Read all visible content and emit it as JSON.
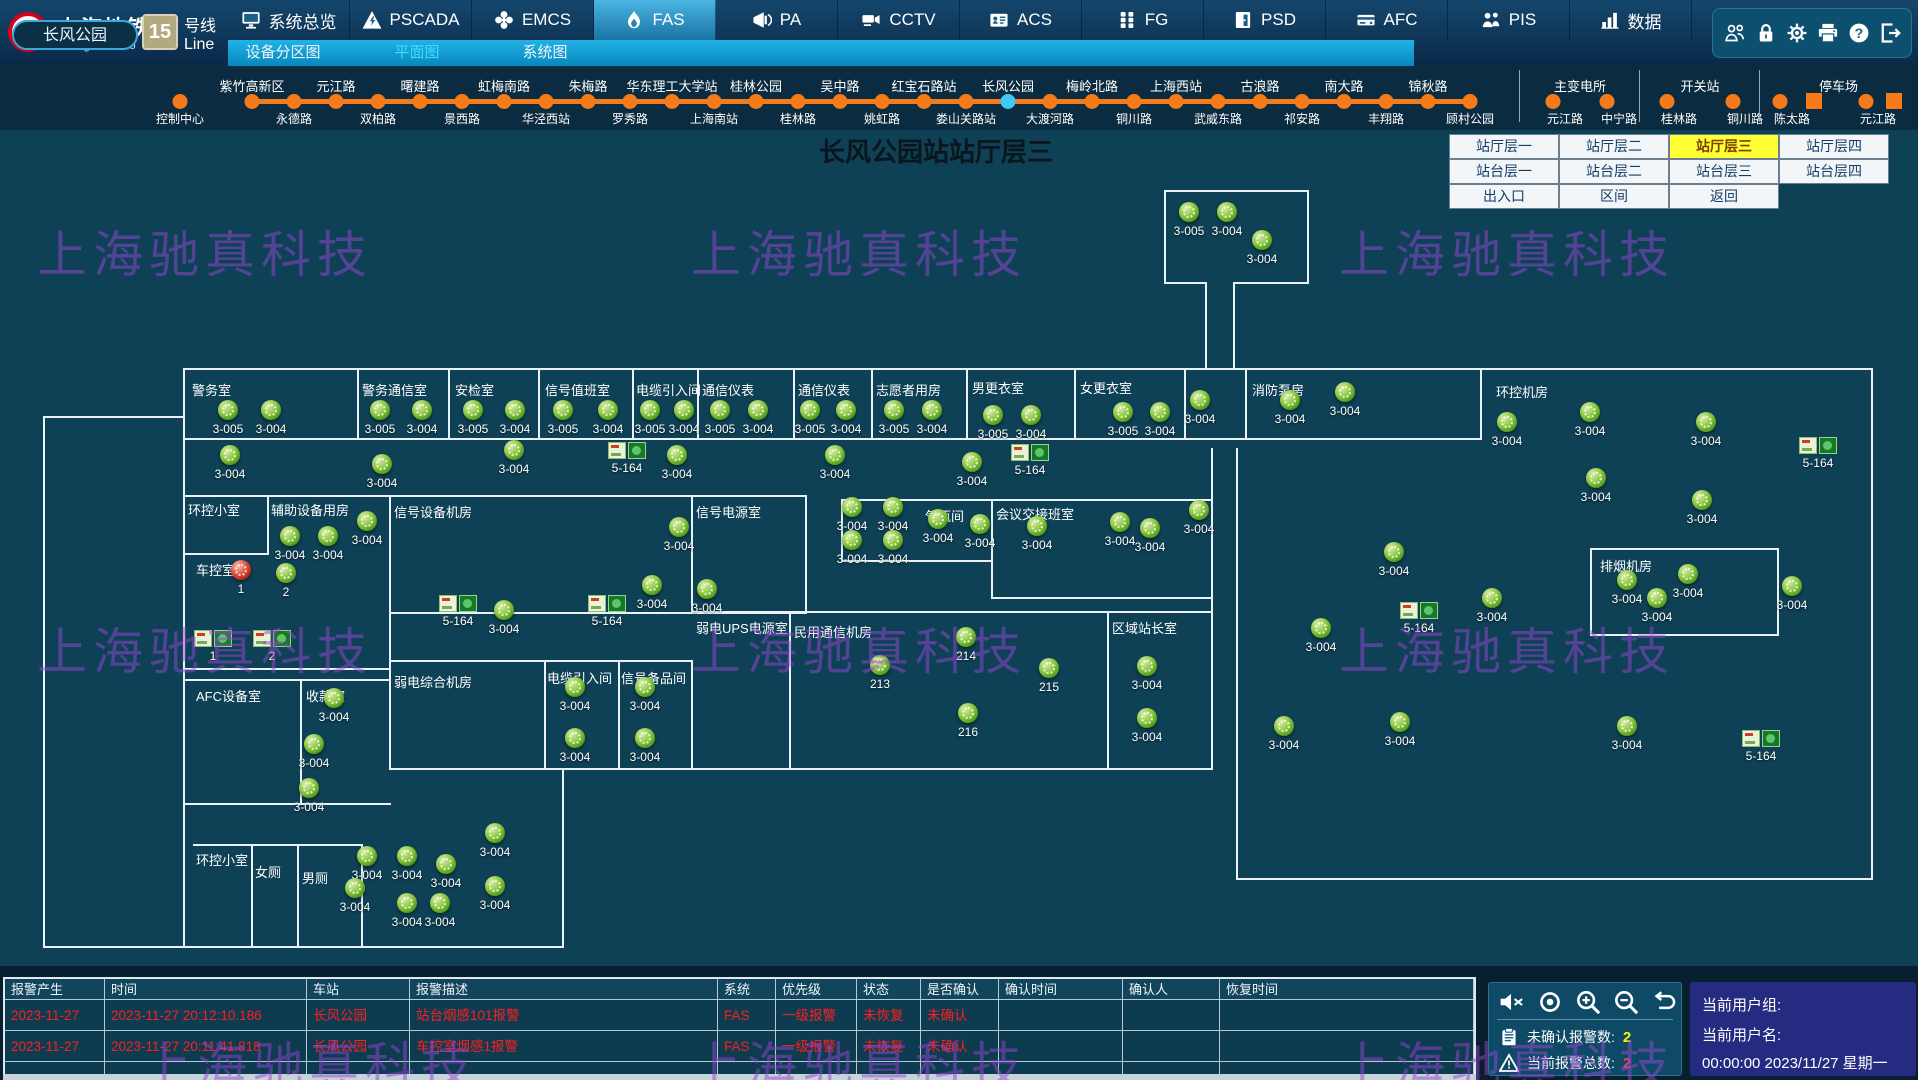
{
  "app": {
    "logo": {
      "cn": "上海地铁",
      "en": "Shanghai Metro",
      "line_number": "15",
      "line_cn": "号线",
      "line_en": "Line"
    },
    "nav_tabs": [
      {
        "label": "系统总览",
        "icon": "monitor",
        "active": false
      },
      {
        "label": "PSCADA",
        "icon": "warning-triangle",
        "active": false
      },
      {
        "label": "EMCS",
        "icon": "fan",
        "active": false
      },
      {
        "label": "FAS",
        "icon": "flame",
        "active": true
      },
      {
        "label": "PA",
        "icon": "megaphone",
        "active": false
      },
      {
        "label": "CCTV",
        "icon": "camera",
        "active": false
      },
      {
        "label": "ACS",
        "icon": "id-card",
        "active": false
      },
      {
        "label": "FG",
        "icon": "grid",
        "active": false
      },
      {
        "label": "PSD",
        "icon": "door",
        "active": false
      },
      {
        "label": "AFC",
        "icon": "card-reader",
        "active": false
      },
      {
        "label": "PIS",
        "icon": "people",
        "active": false
      },
      {
        "label": "数据",
        "icon": "data-chart",
        "active": false
      }
    ],
    "utility_icons": [
      "users",
      "lock",
      "gear",
      "printer",
      "help",
      "logout"
    ]
  },
  "subnav": {
    "items": [
      {
        "label": "设备分区图",
        "x": 283,
        "active": false
      },
      {
        "label": "平面图",
        "x": 417,
        "active": true
      },
      {
        "label": "系统图",
        "x": 545,
        "active": false
      }
    ]
  },
  "line_band": {
    "pill": "长风公园",
    "isolated": {
      "label": "控制中心",
      "x": 180
    },
    "start_x": 252,
    "spacing": 42,
    "current_index": 18,
    "stations": [
      [
        "紫竹高新区",
        "t"
      ],
      [
        "永德路",
        "b"
      ],
      [
        "元江路",
        "t"
      ],
      [
        "双柏路",
        "b"
      ],
      [
        "曙建路",
        "t"
      ],
      [
        "景西路",
        "b"
      ],
      [
        "虹梅南路",
        "t"
      ],
      [
        "华泾西站",
        "b"
      ],
      [
        "朱梅路",
        "t"
      ],
      [
        "罗秀路",
        "b"
      ],
      [
        "华东理工大学站",
        "t"
      ],
      [
        "上海南站",
        "b"
      ],
      [
        "桂林公园",
        "t"
      ],
      [
        "桂林路",
        "b"
      ],
      [
        "吴中路",
        "t"
      ],
      [
        "姚虹路",
        "b"
      ],
      [
        "红宝石路站",
        "t"
      ],
      [
        "娄山关路站",
        "b"
      ],
      [
        "长风公园",
        "t"
      ],
      [
        "大渡河路",
        "b"
      ],
      [
        "梅岭北路",
        "t"
      ],
      [
        "铜川路",
        "b"
      ],
      [
        "上海西站",
        "t"
      ],
      [
        "武威东路",
        "b"
      ],
      [
        "古浪路",
        "t"
      ],
      [
        "祁安路",
        "b"
      ],
      [
        "南大路",
        "t"
      ],
      [
        "丰翔路",
        "b"
      ],
      [
        "锦秋路",
        "t"
      ],
      [
        "顾村公园",
        "b"
      ]
    ],
    "groups": [
      {
        "title": "主变电所",
        "divider_x": 1519,
        "items": [
          [
            "元江路",
            1553,
            "dot"
          ],
          [
            "中宁路",
            1607,
            "dot"
          ]
        ]
      },
      {
        "title": "开关站",
        "divider_x": 1639,
        "items": [
          [
            "桂林路",
            1667,
            "dot"
          ],
          [
            "铜川路",
            1733,
            "dot"
          ]
        ]
      },
      {
        "title": "停车场",
        "divider_x": 1759,
        "items": [
          [
            "陈太路",
            1780,
            "dot"
          ],
          [
            "",
            1814,
            "square"
          ],
          [
            "元江路",
            1866,
            "dot"
          ],
          [
            "",
            1894,
            "square"
          ]
        ]
      }
    ]
  },
  "title": "长风公园站站厅层三",
  "floor_buttons": {
    "x": 1449,
    "y": 134,
    "cell_w": 110,
    "cell_h": 25,
    "rows": [
      [
        {
          "label": "站厅层一"
        },
        {
          "label": "站厅层二"
        },
        {
          "label": "站厅层三",
          "active": true
        },
        {
          "label": "站厅层四"
        }
      ],
      [
        {
          "label": "站台层一"
        },
        {
          "label": "站台层二"
        },
        {
          "label": "站台层三"
        },
        {
          "label": "站台层四"
        }
      ],
      [
        {
          "label": "出入口"
        },
        {
          "label": "区间"
        },
        {
          "label": "返回"
        }
      ]
    ]
  },
  "floor_plan": {
    "rooms": [
      [
        192,
        380,
        "警务室"
      ],
      [
        362,
        380,
        "警务通信室"
      ],
      [
        455,
        380,
        "安检室"
      ],
      [
        545,
        380,
        "信号值班室"
      ],
      [
        636,
        380,
        "电缆引入间"
      ],
      [
        702,
        380,
        "通信仪表"
      ],
      [
        798,
        380,
        "通信仪表"
      ],
      [
        876,
        380,
        "志愿者用房"
      ],
      [
        972,
        378,
        "男更衣室"
      ],
      [
        1080,
        378,
        "女更衣室"
      ],
      [
        1252,
        380,
        "消防泵房"
      ],
      [
        1496,
        382,
        "环控机房"
      ],
      [
        188,
        500,
        "环控小室"
      ],
      [
        271,
        500,
        "辅助设备用房"
      ],
      [
        196,
        560,
        "车控室"
      ],
      [
        394,
        502,
        "信号设备机房"
      ],
      [
        696,
        502,
        "信号电源室"
      ],
      [
        394,
        672,
        "弱电综合机房"
      ],
      [
        547,
        668,
        "电缆引入间"
      ],
      [
        621,
        668,
        "信号备品间"
      ],
      [
        696,
        618,
        "弱电UPS电源室"
      ],
      [
        794,
        622,
        "民用通信机房"
      ],
      [
        925,
        506,
        "气瓶间"
      ],
      [
        996,
        504,
        "会议交接班室"
      ],
      [
        1112,
        618,
        "区域站长室"
      ],
      [
        1600,
        556,
        "排烟机房"
      ],
      [
        196,
        686,
        "AFC设备室"
      ],
      [
        306,
        686,
        "收款室"
      ],
      [
        196,
        850,
        "环控小室"
      ],
      [
        255,
        862,
        "女厕"
      ],
      [
        302,
        868,
        "男厕"
      ]
    ],
    "walls": [
      [
        43,
        416,
        142,
        2
      ],
      [
        183,
        368,
        1690,
        2
      ],
      [
        183,
        438,
        1299,
        2
      ],
      [
        183,
        495,
        208,
        2
      ],
      [
        183,
        553,
        86,
        2
      ],
      [
        183,
        668,
        208,
        2
      ],
      [
        183,
        679,
        208,
        2
      ],
      [
        183,
        803,
        208,
        2
      ],
      [
        193,
        844,
        170,
        2
      ],
      [
        43,
        946,
        521,
        2
      ],
      [
        389,
        495,
        418,
        2
      ],
      [
        389,
        612,
        418,
        2
      ],
      [
        389,
        660,
        304,
        2
      ],
      [
        389,
        768,
        824,
        2
      ],
      [
        691,
        611,
        418,
        2
      ],
      [
        841,
        499,
        372,
        2
      ],
      [
        841,
        560,
        152,
        2
      ],
      [
        991,
        597,
        222,
        2
      ],
      [
        1107,
        611,
        106,
        2
      ],
      [
        1590,
        548,
        189,
        2
      ],
      [
        1590,
        634,
        189,
        2
      ],
      [
        1164,
        190,
        145,
        2
      ],
      [
        1164,
        282,
        43,
        2
      ],
      [
        1233,
        282,
        76,
        2
      ],
      [
        1236,
        878,
        637,
        2
      ],
      [
        43,
        416,
        2,
        532
      ],
      [
        183,
        368,
        2,
        580
      ],
      [
        267,
        495,
        2,
        60
      ],
      [
        300,
        679,
        2,
        126
      ],
      [
        251,
        844,
        2,
        104
      ],
      [
        297,
        844,
        2,
        104
      ],
      [
        361,
        844,
        2,
        104
      ],
      [
        357,
        368,
        2,
        72
      ],
      [
        448,
        368,
        2,
        72
      ],
      [
        538,
        368,
        2,
        72
      ],
      [
        632,
        368,
        2,
        72
      ],
      [
        697,
        368,
        2,
        72
      ],
      [
        793,
        368,
        2,
        72
      ],
      [
        871,
        368,
        2,
        72
      ],
      [
        966,
        368,
        2,
        72
      ],
      [
        1074,
        368,
        2,
        72
      ],
      [
        1184,
        368,
        2,
        72
      ],
      [
        1245,
        368,
        2,
        72
      ],
      [
        1480,
        368,
        2,
        72
      ],
      [
        389,
        495,
        2,
        275
      ],
      [
        691,
        495,
        2,
        119
      ],
      [
        805,
        495,
        2,
        119
      ],
      [
        544,
        660,
        2,
        110
      ],
      [
        618,
        660,
        2,
        110
      ],
      [
        691,
        660,
        2,
        110
      ],
      [
        789,
        611,
        2,
        159
      ],
      [
        1107,
        611,
        2,
        159
      ],
      [
        1211,
        448,
        2,
        322
      ],
      [
        1236,
        448,
        2,
        322
      ],
      [
        841,
        499,
        2,
        63
      ],
      [
        991,
        499,
        2,
        100
      ],
      [
        1164,
        190,
        2,
        94
      ],
      [
        1307,
        190,
        2,
        94
      ],
      [
        1205,
        284,
        2,
        84
      ],
      [
        1233,
        284,
        2,
        84
      ],
      [
        1590,
        548,
        2,
        88
      ],
      [
        1777,
        548,
        2,
        88
      ],
      [
        1871,
        368,
        2,
        512
      ],
      [
        562,
        768,
        2,
        180
      ],
      [
        1236,
        768,
        2,
        112
      ]
    ],
    "detectors": [
      [
        228,
        410,
        "3-005"
      ],
      [
        271,
        410,
        "3-004"
      ],
      [
        380,
        410,
        "3-005"
      ],
      [
        422,
        410,
        "3-004"
      ],
      [
        473,
        410,
        "3-005"
      ],
      [
        515,
        410,
        "3-004"
      ],
      [
        563,
        410,
        "3-005"
      ],
      [
        608,
        410,
        "3-004"
      ],
      [
        650,
        410,
        "3-005"
      ],
      [
        684,
        410,
        "3-004"
      ],
      [
        720,
        410,
        "3-005"
      ],
      [
        758,
        410,
        "3-004"
      ],
      [
        810,
        410,
        "3-005"
      ],
      [
        846,
        410,
        "3-004"
      ],
      [
        894,
        410,
        "3-005"
      ],
      [
        932,
        410,
        "3-004"
      ],
      [
        993,
        415,
        "3-005"
      ],
      [
        1031,
        415,
        "3-004"
      ],
      [
        1123,
        412,
        "3-005"
      ],
      [
        1160,
        412,
        "3-004"
      ],
      [
        1200,
        400,
        "3-004"
      ],
      [
        1290,
        400,
        "3-004"
      ],
      [
        1345,
        392,
        "3-004"
      ],
      [
        1189,
        212,
        "3-005"
      ],
      [
        1227,
        212,
        "3-004"
      ],
      [
        1262,
        240,
        "3-004"
      ],
      [
        1507,
        422,
        "3-004"
      ],
      [
        1590,
        412,
        "3-004"
      ],
      [
        1706,
        422,
        "3-004"
      ],
      [
        1818,
        445,
        "5-164",
        "box"
      ],
      [
        1596,
        478,
        "3-004"
      ],
      [
        1702,
        500,
        "3-004"
      ],
      [
        230,
        455,
        "3-004"
      ],
      [
        382,
        464,
        "3-004"
      ],
      [
        514,
        450,
        "3-004"
      ],
      [
        627,
        450,
        "5-164",
        "box"
      ],
      [
        677,
        455,
        "3-004"
      ],
      [
        835,
        455,
        "3-004"
      ],
      [
        972,
        462,
        "3-004"
      ],
      [
        1030,
        452,
        "5-164",
        "box"
      ],
      [
        1199,
        510,
        "3-004"
      ],
      [
        1150,
        528,
        "3-004"
      ],
      [
        290,
        536,
        "3-004"
      ],
      [
        328,
        536,
        "3-004"
      ],
      [
        367,
        521,
        "3-004"
      ],
      [
        241,
        570,
        "1",
        "red"
      ],
      [
        286,
        573,
        "2"
      ],
      [
        213,
        638,
        "1",
        "box"
      ],
      [
        272,
        638,
        "2",
        "box"
      ],
      [
        334,
        698,
        "3-004"
      ],
      [
        314,
        744,
        "3-004"
      ],
      [
        309,
        788,
        "3-004"
      ],
      [
        367,
        856,
        "3-004"
      ],
      [
        407,
        856,
        "3-004"
      ],
      [
        446,
        864,
        "3-004"
      ],
      [
        495,
        833,
        "3-004"
      ],
      [
        495,
        886,
        "3-004"
      ],
      [
        355,
        888,
        "3-004"
      ],
      [
        407,
        903,
        "3-004"
      ],
      [
        440,
        903,
        "3-004"
      ],
      [
        652,
        585,
        "3-004"
      ],
      [
        707,
        589,
        "3-004"
      ],
      [
        679,
        527,
        "3-004"
      ],
      [
        504,
        610,
        "3-004"
      ],
      [
        458,
        603,
        "5-164",
        "box"
      ],
      [
        607,
        603,
        "5-164",
        "box"
      ],
      [
        575,
        687,
        "3-004"
      ],
      [
        575,
        738,
        "3-004"
      ],
      [
        645,
        687,
        "3-004"
      ],
      [
        645,
        738,
        "3-004"
      ],
      [
        880,
        665,
        "213"
      ],
      [
        966,
        637,
        "214"
      ],
      [
        1049,
        668,
        "215"
      ],
      [
        968,
        713,
        "216"
      ],
      [
        852,
        507,
        "3-004"
      ],
      [
        893,
        507,
        "3-004"
      ],
      [
        852,
        540,
        "3-004"
      ],
      [
        893,
        540,
        "3-004"
      ],
      [
        938,
        519,
        "3-004"
      ],
      [
        980,
        524,
        "3-004"
      ],
      [
        1037,
        526,
        "3-004"
      ],
      [
        1120,
        522,
        "3-004"
      ],
      [
        1147,
        666,
        "3-004"
      ],
      [
        1147,
        718,
        "3-004"
      ],
      [
        1627,
        580,
        "3-004"
      ],
      [
        1688,
        574,
        "3-004"
      ],
      [
        1792,
        586,
        "3-004"
      ],
      [
        1394,
        552,
        "3-004"
      ],
      [
        1321,
        628,
        "3-004"
      ],
      [
        1419,
        610,
        "5-164",
        "box"
      ],
      [
        1492,
        598,
        "3-004"
      ],
      [
        1657,
        598,
        "3-004"
      ],
      [
        1627,
        726,
        "3-004"
      ],
      [
        1400,
        722,
        "3-004"
      ],
      [
        1284,
        726,
        "3-004"
      ],
      [
        1761,
        738,
        "5-164",
        "box"
      ]
    ]
  },
  "watermark": {
    "text": "上海驰真科技",
    "positions": [
      [
        37,
        215
      ],
      [
        691,
        215
      ],
      [
        1339,
        215
      ],
      [
        37,
        612
      ],
      [
        691,
        612
      ],
      [
        1339,
        612
      ],
      [
        141,
        1026
      ],
      [
        691,
        1026
      ],
      [
        1339,
        1026
      ]
    ]
  },
  "alarm_table": {
    "columns": [
      {
        "label": "报警产生",
        "w": 100
      },
      {
        "label": "时间",
        "w": 202
      },
      {
        "label": "车站",
        "w": 103
      },
      {
        "label": "报警描述",
        "w": 308
      },
      {
        "label": "系统",
        "w": 58
      },
      {
        "label": "优先级",
        "w": 81
      },
      {
        "label": "状态",
        "w": 64
      },
      {
        "label": "是否确认",
        "w": 78
      },
      {
        "label": "确认时间",
        "w": 124
      },
      {
        "label": "确认人",
        "w": 97
      },
      {
        "label": "恢复时间",
        "w": 254
      }
    ],
    "rows": [
      [
        "2023-11-27",
        "2023-11-27 20:12:10.186",
        "长风公园",
        "站台烟感101报警",
        "FAS",
        "一级报警",
        "未恢复",
        "未确认",
        "",
        "",
        ""
      ],
      [
        "2023-11-27",
        "2023-11-27 20:11:41.818",
        "长风公园",
        "车控室烟感1报警",
        "FAS",
        "一级报警",
        "未恢复",
        "未确认",
        "",
        "",
        ""
      ],
      [
        "",
        "",
        "",
        "",
        "",
        "",
        "",
        "",
        "",
        "",
        ""
      ]
    ]
  },
  "control_panel": {
    "icons": [
      "mute",
      "eye",
      "zoom-in",
      "zoom-out",
      "undo"
    ],
    "counters": [
      {
        "icon": "clipboard",
        "label": "未确认报警数:",
        "value": "2",
        "color": "#ffee00"
      },
      {
        "icon": "warning-open",
        "label": "当前报警总数:",
        "value": "2",
        "color": "#ff3d66"
      }
    ]
  },
  "user_panel": {
    "group_label": "当前用户组:",
    "name_label": "当前用户名:",
    "clock": "00:00:00   2023/11/27   星期一"
  }
}
